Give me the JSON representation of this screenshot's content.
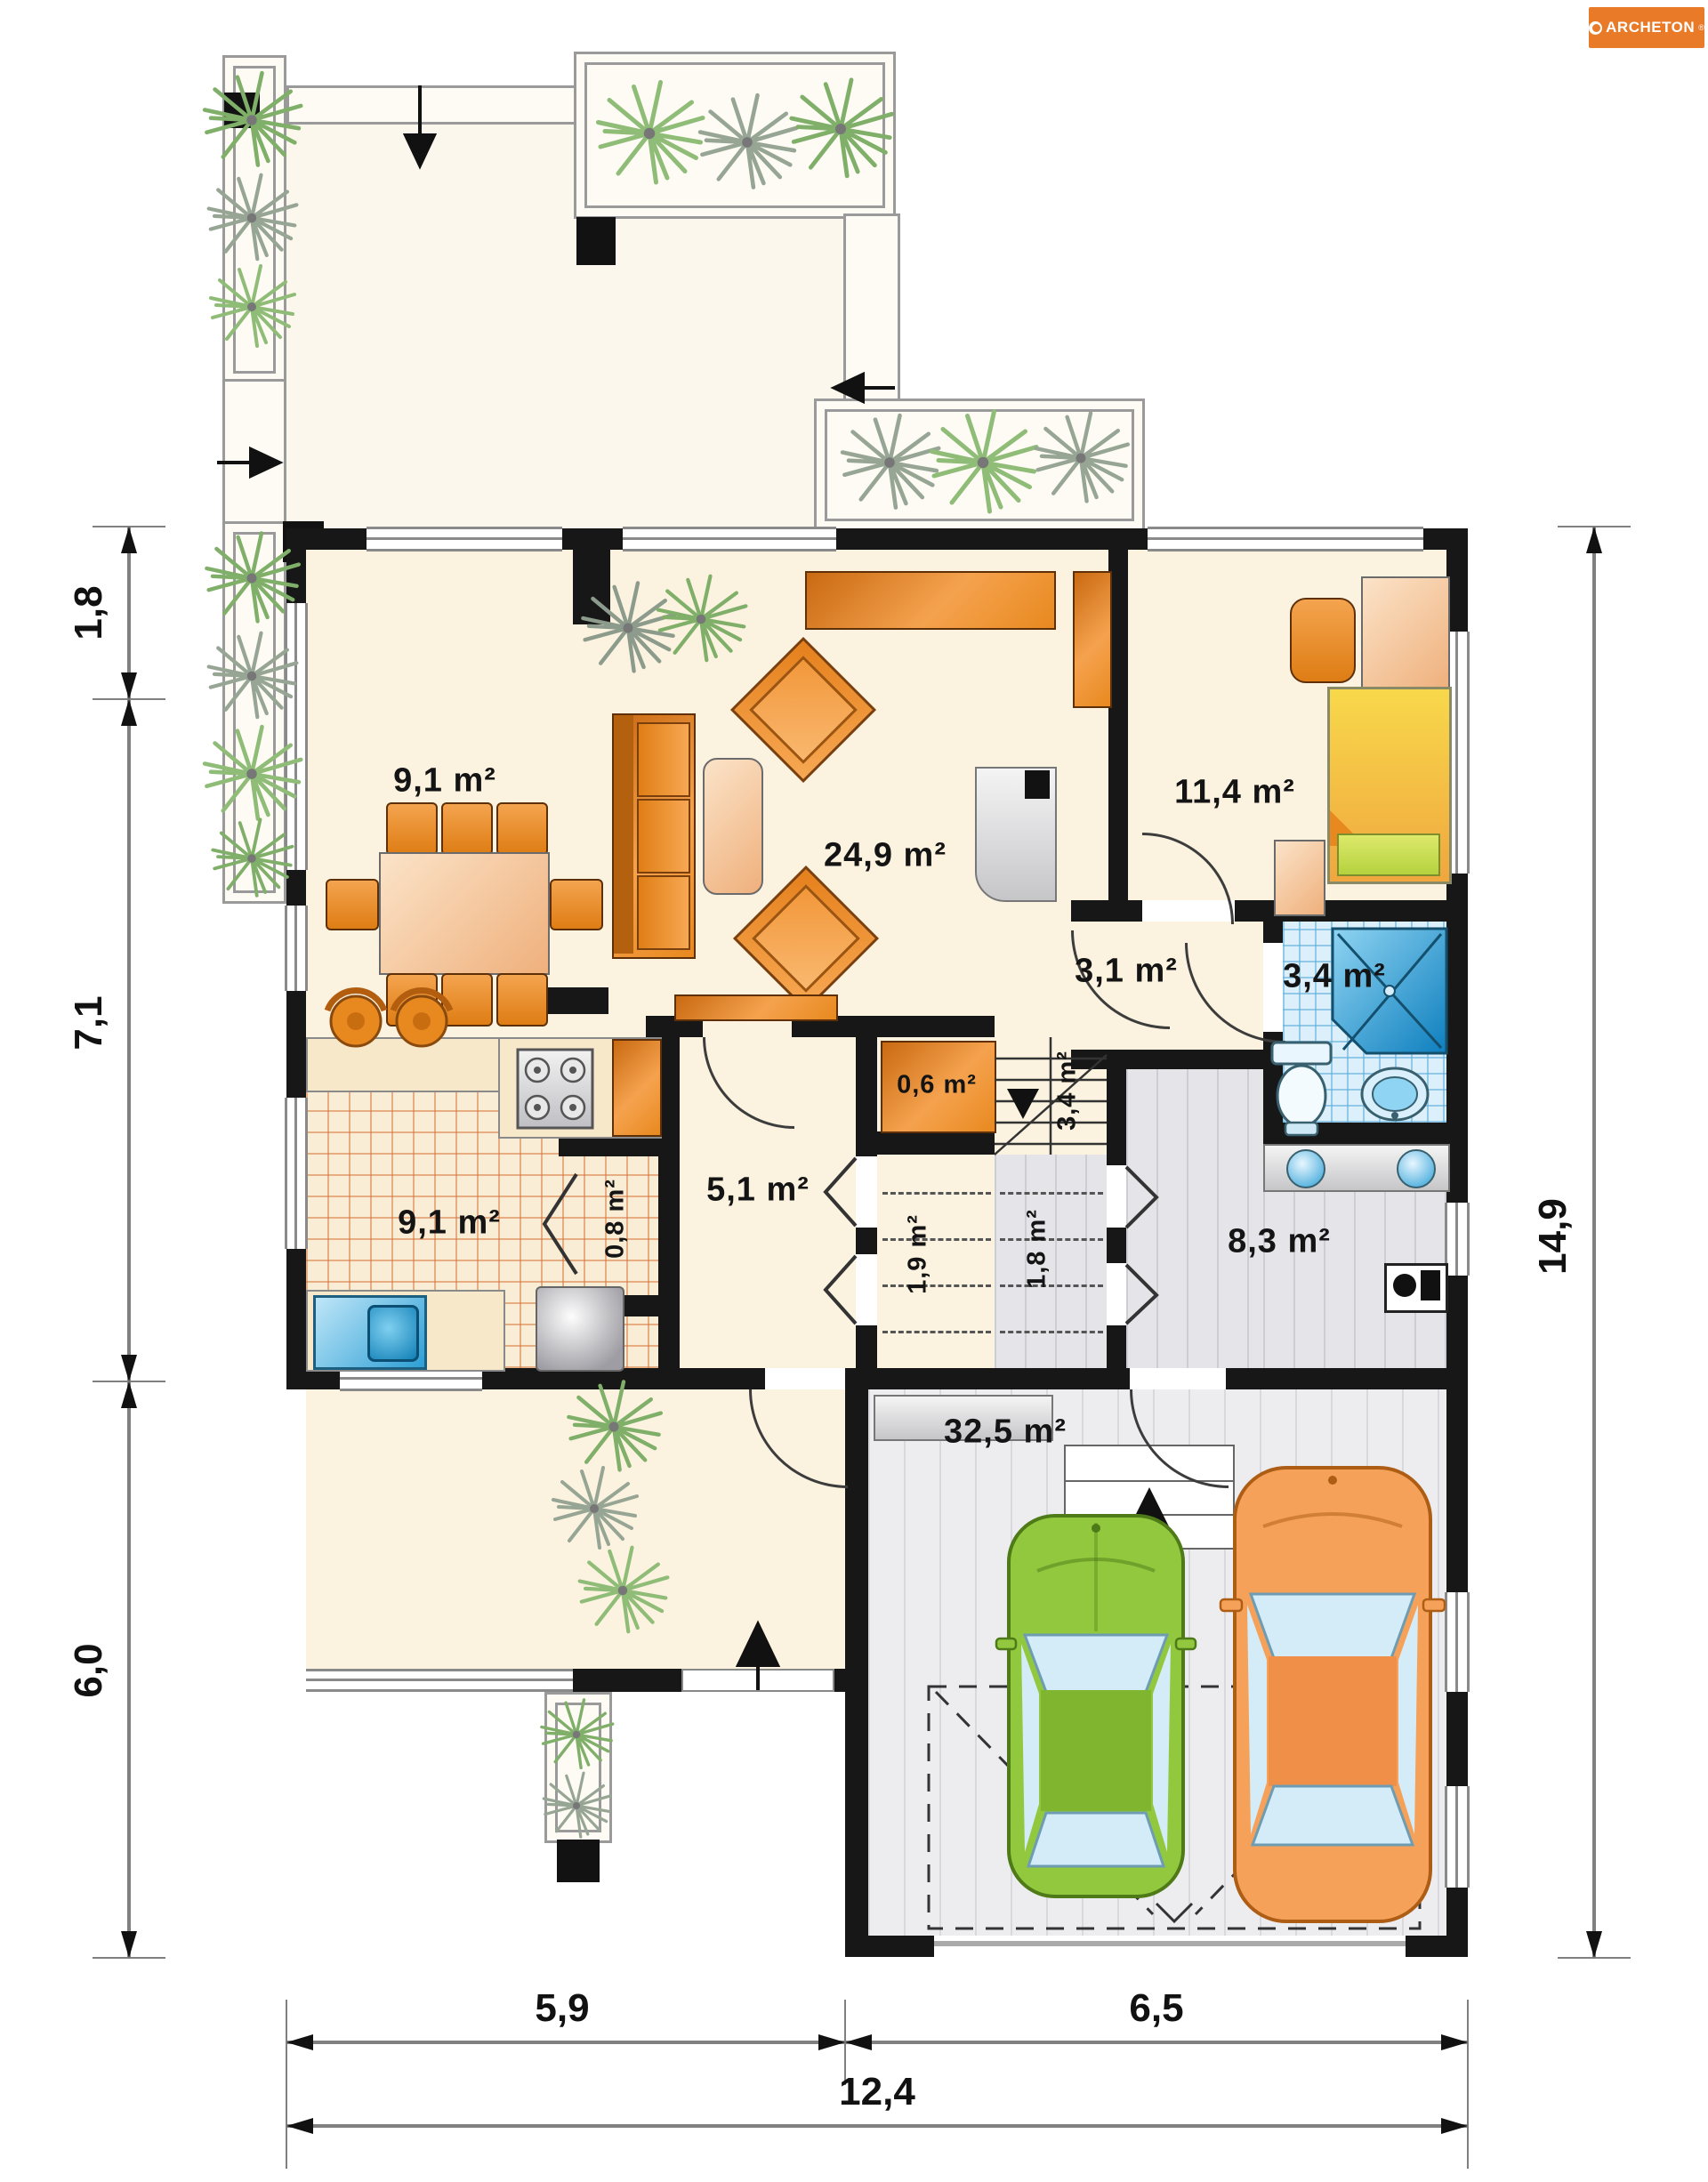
{
  "brand": {
    "name": "ARCHETON",
    "reg": "®",
    "color": "#E87A28"
  },
  "areas": {
    "dining": "9,1 m²",
    "living": "24,9 m²",
    "bedroom": "11,4 m²",
    "hall_upper": "3,1 m²",
    "bathroom": "3,4 m²",
    "wardrobe": "0,6 m²",
    "stairs": "3,4 m²",
    "kitchen": "9,1 m²",
    "pantry": "0,8 m²",
    "hall": "5,1 m²",
    "corridor_a": "1,9 m²",
    "corridor_b": "1,8 m²",
    "utility": "8,3 m²",
    "garage": "32,5 m²"
  },
  "dims": {
    "left_top": "1,8",
    "left_mid": "7,1",
    "left_bottom": "6,0",
    "right_total": "14,9",
    "bottom_left": "5,9",
    "bottom_right": "6,5",
    "bottom_total": "12,4"
  }
}
